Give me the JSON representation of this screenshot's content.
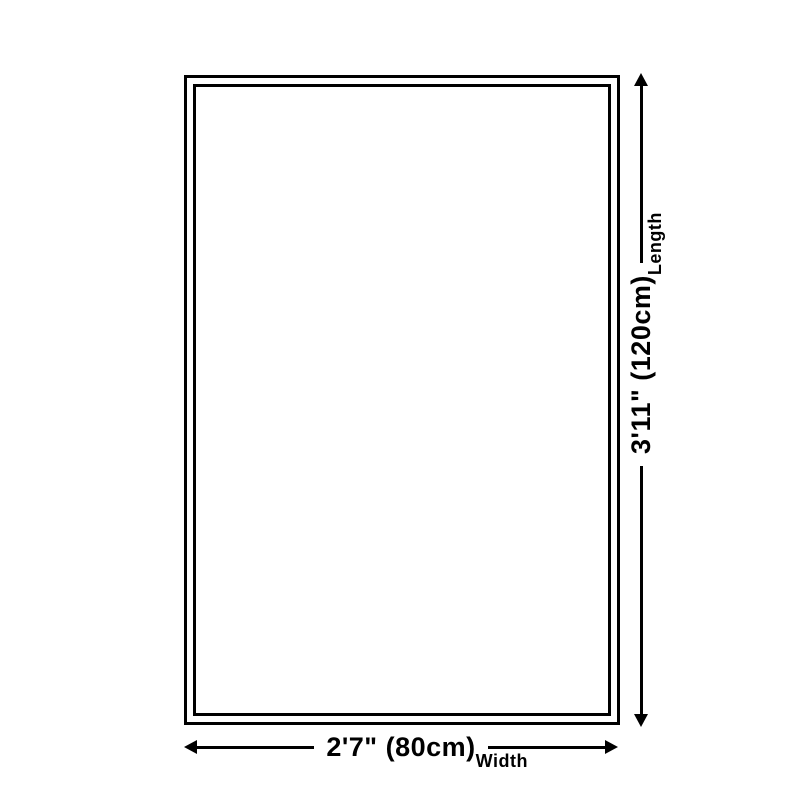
{
  "page": {
    "background_color": "#ffffff",
    "line_color": "#000000",
    "text_color": "#000000"
  },
  "diagram": {
    "type": "product-size-diagram",
    "shape": "rectangle",
    "length_dimension": {
      "value": "3'11\" (120cm)",
      "label": "Length"
    },
    "width_dimension": {
      "value": "2'7\" (80cm)",
      "label": "Width"
    }
  }
}
